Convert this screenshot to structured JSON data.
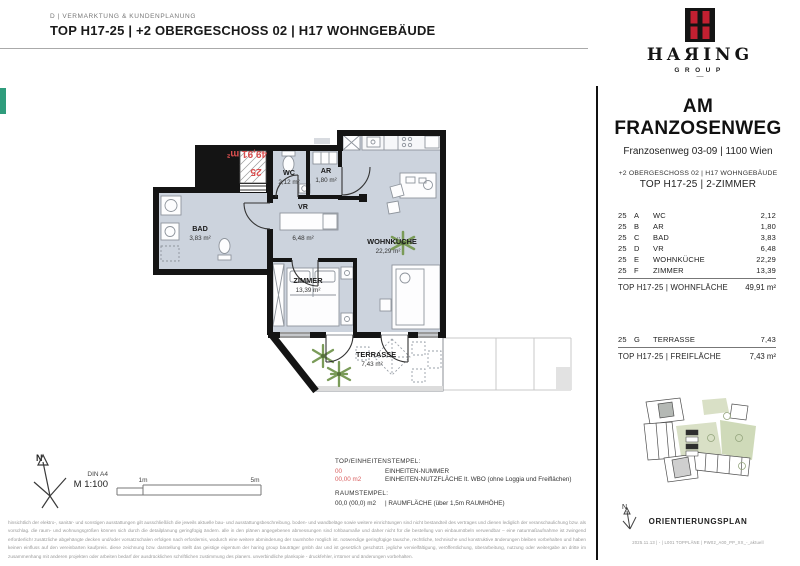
{
  "colors": {
    "accent_red": "#d94f4f",
    "logo_red": "#c32031",
    "floor_gray": "#ccd3dd",
    "wall_black": "#141414",
    "plant_green": "#7a9b58",
    "tab_teal": "#2f9c7c"
  },
  "header": {
    "department": "D | VERMARKTUNG & KUNDENPLANUNG",
    "title": "TOP H17-25 | +2 OBERGESCHOSS 02 | H17 WOHNGEBÄUDE"
  },
  "logo": {
    "wordmark": "HAЯING",
    "group": "GROUP",
    "dash": "—"
  },
  "project": {
    "name": "AM FRANZOSENWEG",
    "address": "Franzosenweg 03-09 | 1100 Wien",
    "subline": "+2 OBERGESCHOSS 02 | H17 WOHNGEBÄUDE",
    "unit_line": "TOP H17-25 | 2-ZIMMER"
  },
  "rooms_table": {
    "rows": [
      {
        "unit": "25",
        "letter": "A",
        "name": "WC",
        "value": "2,12"
      },
      {
        "unit": "25",
        "letter": "B",
        "name": "AR",
        "value": "1,80"
      },
      {
        "unit": "25",
        "letter": "C",
        "name": "BAD",
        "value": "3,83"
      },
      {
        "unit": "25",
        "letter": "D",
        "name": "VR",
        "value": "6,48"
      },
      {
        "unit": "25",
        "letter": "E",
        "name": "WOHNKÜCHE",
        "value": "22,29"
      },
      {
        "unit": "25",
        "letter": "F",
        "name": "ZIMMER",
        "value": "13,39"
      }
    ],
    "total_label": "TOP H17-25 | WOHNFLÄCHE",
    "total_value": "49,91 m²"
  },
  "freiflaeche_table": {
    "rows": [
      {
        "unit": "25",
        "letter": "G",
        "name": "TERRASSE",
        "value": "7,43"
      }
    ],
    "total_label": "TOP H17-25 | FREIFLÄCHE",
    "total_value": "7,43 m²"
  },
  "plan": {
    "stamp": {
      "unit": "25",
      "area": "49,91 m²"
    },
    "rooms": {
      "wc": {
        "name": "WC",
        "area": "2,12 m²"
      },
      "ar": {
        "name": "AR",
        "area": "1,80 m²"
      },
      "bad": {
        "name": "BAD",
        "area": "3,83 m²"
      },
      "vr": {
        "name": "VR",
        "area": "6,48 m²"
      },
      "wohnkueche": {
        "name": "WOHNKÜCHE",
        "area": "22,29 m²"
      },
      "zimmer": {
        "name": "ZIMMER",
        "area": "13,39 m²"
      },
      "terrasse": {
        "name": "TERRASSE",
        "area": "7,43 m²"
      }
    }
  },
  "legend": {
    "north": "N",
    "din": "DIN A4",
    "scale": "M 1:100",
    "scale_1m": "1m",
    "scale_5m": "5m",
    "stamp_title": "TOP/EINHEITENSTEMPEL:",
    "stamp_rows": [
      {
        "example": "00",
        "desc": "EINHEITEN-NUMMER"
      },
      {
        "example": "00,00 m2",
        "desc": "EINHEITEN-NUTZFLÄCHE lt. WBO (ohne Loggia und Freiflächen)"
      }
    ],
    "raum_title": "RAUMSTEMPEL:",
    "raum_example": "00,0 (00,0) m2",
    "raum_desc": "| RAUMFLÄCHE (über 1,5m RAUMHÖHE)"
  },
  "orientation": {
    "north": "N",
    "title": "ORIENTIERUNGSPLAN",
    "footer": "2025.11.13 | - | L001 TOPPLÄNE | PW02_A00_PP_XX_-_aktuell"
  },
  "disclaimer": "hinsichtlich der elektro-, sanitär- und sonstigen ausstattungen gilt ausschließlich die jeweils aktuelle bau- und ausstattungsbeschreibung. boden- und wandbeläge sowie weitere einrichtungen sind nicht bestandteil des vertrages und dienen lediglich der veranschaulichung bzw. als vorschlag. die raum- und wohnungsgrößen können sich durch die detailplanung geringfügig ändern. alle in den plänen angegebenen abmessungen sind rohbaumaße und daher nicht für die bestellung von einbaumöbeln verwendbar – eine naturmaßaufnahme ist zwingend erforderlich! zusätzliche abgehängte decken und/oder vorsatzschalen erfolgen nach erfordernis, wodurch eine weitere abminderung der raumhöhe möglich ist. notwendige geringfügige tausche, rechtliche, technische und konstruktive änderungen bleiben vorbehalten und haben keinen einfluss auf den vereinbarten kaufpreis. diese zeichnung bzw. darstellung stellt das geistige eigentum der haring group bauträger gmbh dar und ist gesetzlich geschützt. jegliche vervielfältigung, veröffentlichung, überarbeitung, nutzung oder weitergabe an dritte im zusammenhang mit anderen projekten oder arbeiten bedarf der ausdrücklichen schriftlichen zustimmung des planers. unverbindliche plankopie - druckfehler, irrtümer und änderungen vorbehalten."
}
